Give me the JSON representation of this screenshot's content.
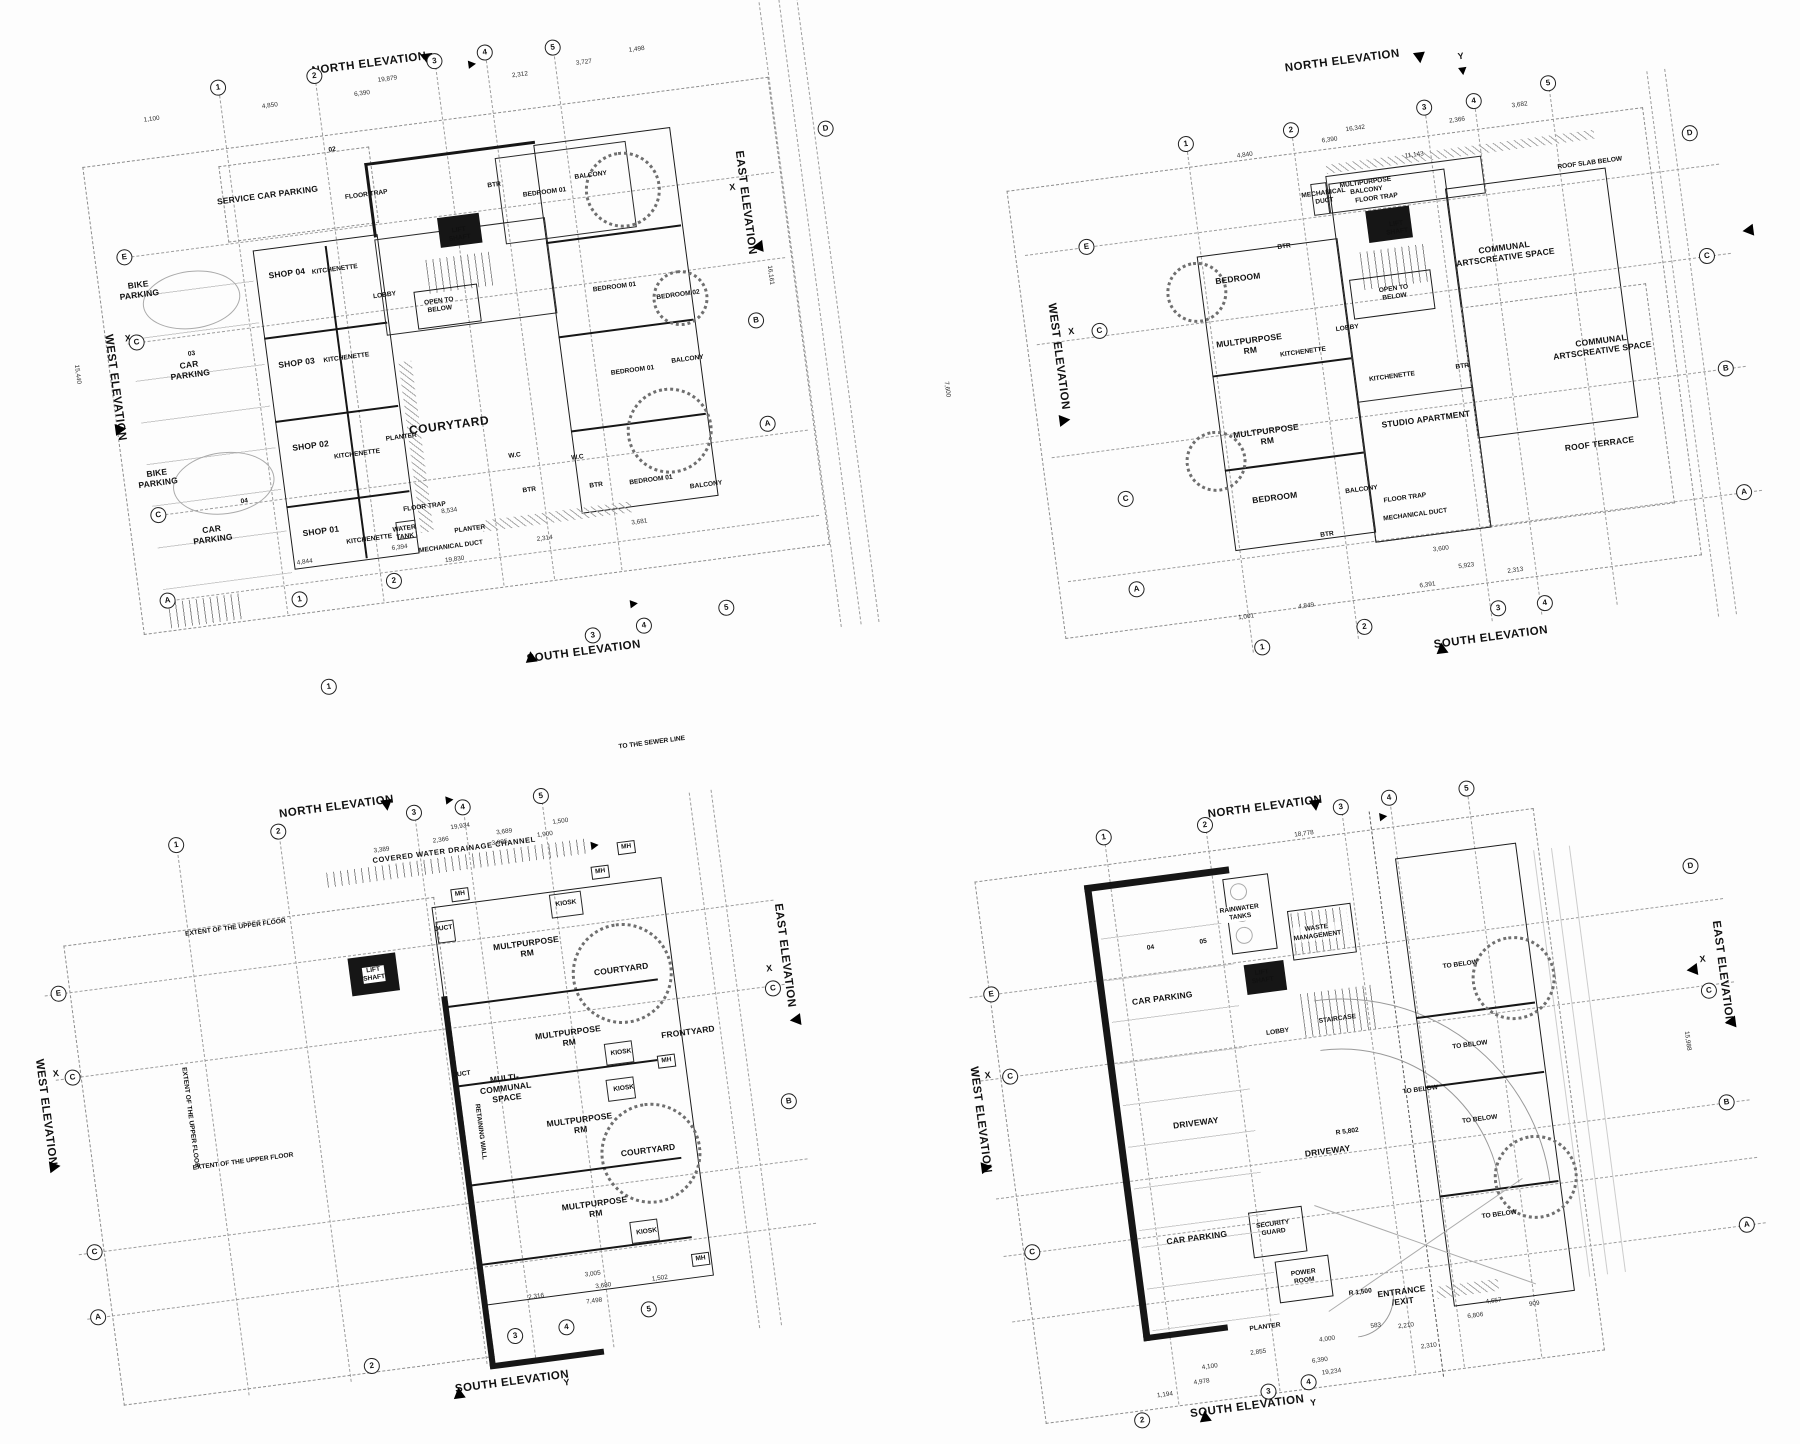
{
  "sheet": {
    "kind": "architectural floor plan drawings",
    "plan_count": 4,
    "ink": "#141414",
    "paper": "#fdfdfd"
  },
  "plans": [
    {
      "elev": {
        "n": "NORTH ELEVATION",
        "s": "SOUTH ELEVATION",
        "w": "WEST ELEVATION",
        "e": "EAST ELEVATION"
      },
      "grid_top": [
        "1",
        "2",
        "3",
        "4",
        "5"
      ],
      "grid_left": [
        "E",
        "C",
        "C",
        "A"
      ],
      "grid_right": [
        "D",
        "B",
        "A"
      ],
      "grid_bottom": [
        "1",
        "2",
        "3",
        "4",
        "5"
      ],
      "marks": [
        "X",
        "X"
      ],
      "rooms": [
        "SERVICE CAR PARKING",
        "FLOOR TRAP",
        "BIKE\nPARKING",
        "SHOP 04",
        "KITCHENETTE",
        "LOBBY",
        "LIFT\nSHAFT",
        "OPEN TO\nBELOW",
        "BTR",
        "BEDROOM 01",
        "BALCONY",
        "BEDROOM 01",
        "BEDROOM 02",
        "BALCONY",
        "CAR\nPARKING",
        "SHOP 03",
        "KITCHENETTE",
        "COURYTARD",
        "PLANTER",
        "W.C",
        "BTR",
        "BEDROOM 01",
        "BALCONY",
        "BIKE\nPARKING",
        "SHOP 02",
        "KITCHENETTE",
        "CAR\nPARKING",
        "SHOP 01",
        "KITCHENETTE",
        "WATER\nTANK",
        "FLOOR TRAP",
        "PLANTER",
        "MECHANICAL DUCT",
        "BEDROOM 01",
        "BTR",
        "W.C",
        "02",
        "03",
        "04"
      ],
      "dims": [
        "19,879",
        "6,390",
        "4,850",
        "1,100",
        "2,312",
        "3,727",
        "1,498",
        "19,830",
        "6,394",
        "4,844",
        "8,534",
        "2,314",
        "3,681",
        "15,440",
        "16,161"
      ]
    },
    {
      "elev": {
        "n": "NORTH ELEVATION",
        "s": "SOUTH ELEVATION",
        "w": "WEST ELEVATION"
      },
      "grid_top": [
        "1",
        "2",
        "3",
        "4",
        "5"
      ],
      "grid_left": [
        "E",
        "C",
        "C",
        "A"
      ],
      "grid_right": [
        "D",
        "C",
        "B",
        "A"
      ],
      "grid_bottom": [
        "1",
        "2",
        "3",
        "4"
      ],
      "marks": [
        "Y",
        "X"
      ],
      "rooms": [
        "MULTIPURPOSE\nBALCONY",
        "MECHANICAL\nDUCT",
        "FLOOR TRAP",
        "LIFT\nSHAFT",
        "ROOF SLAB BELOW",
        "BTR",
        "BEDROOM",
        "OPEN TO\nBELOW",
        "COMMUNAL\nARTSCREATIVE SPACE",
        "MULTPURPOSE\nRM",
        "KITCHENETTE",
        "LOBBY",
        "BTR",
        "KITCHENETTE",
        "STUDIO APARTMENT",
        "COMMUNAL\nARTSCREATIVE SPACE",
        "ROOF TERRACE",
        "MULTPURPOSE\nRM",
        "BEDROOM",
        "BALCONY",
        "FLOOR TRAP",
        "MECHANICAL DUCT",
        "BTR"
      ],
      "dims": [
        "16,342",
        "6,390",
        "4,840",
        "2,366",
        "3,682",
        "11,143",
        "4,849",
        "6,391",
        "1,001",
        "5,923",
        "2,313",
        "3,600",
        "7,600"
      ]
    },
    {
      "elev": {
        "n": "NORTH ELEVATION",
        "s": "SOUTH ELEVATION",
        "w": "WEST ELEVATION",
        "e": "EAST ELEVATION"
      },
      "grid_top": [
        "1",
        "2",
        "3",
        "4",
        "5",
        "1"
      ],
      "grid_left": [
        "E",
        "C",
        "C",
        "A"
      ],
      "grid_right": [
        "C",
        "B"
      ],
      "grid_bottom": [
        "2",
        "3",
        "4",
        "5"
      ],
      "marks": [
        "X",
        "X",
        "Y"
      ],
      "mh": [
        "MH",
        "MH",
        "MH",
        "MH",
        "MH"
      ],
      "rooms": [
        "COVERED WATER DRAINAGE CHANNEL",
        "TO THE SEWER LINE",
        "KIOSK",
        "MULTPURPOSE\nRM",
        "COURTYARD",
        "LIFT\nSHAFT",
        "DUCT",
        "EXTENT OF THE UPPER FLOOR",
        "MULTPURPOSE\nRM",
        "KIOSK",
        "KIOSK",
        "FRONTYARD",
        "MULTI-\nCOMMUNAL\nSPACE",
        "DUCT",
        "RETAINING WALL",
        "MULTPURPOSE\nRM",
        "COURTYARD",
        "MULTPURPOSE\nRM",
        "KIOSK",
        "EXTENT OF THE UPPER FLOOR",
        "EXTENT OF THE UPPER FLOOR"
      ],
      "dims": [
        "19,934",
        "2,366",
        "3,689",
        "1,500",
        "3,389",
        "3,005",
        "1,900",
        "2,316",
        "7,498",
        "3,680",
        "3,005",
        "1,502"
      ]
    },
    {
      "elev": {
        "n": "NORTH ELEVATION",
        "s": "SOUTH ELEVATION",
        "w": "WEST ELEVATION",
        "e": "EAST ELEVATION"
      },
      "grid_top": [
        "1",
        "2",
        "3",
        "4",
        "5"
      ],
      "grid_left": [
        "E",
        "C",
        "C"
      ],
      "grid_right": [
        "D",
        "C",
        "B",
        "A"
      ],
      "grid_bottom": [
        "2",
        "3",
        "4"
      ],
      "marks": [
        "X",
        "X",
        "Y"
      ],
      "rooms": [
        "RAINWATER\nTANKS",
        "WASTE\nMANAGEMENT",
        "TO BELOW",
        "LIFT\nSHAFT",
        "CAR PARKING",
        "STAIRCASE",
        "LOBBY",
        "TO BELOW",
        "TO BELOW",
        "TO BELOW",
        "DRIVEWAY",
        "R 5,802",
        "DRIVEWAY",
        "SECURITY\nGUARD",
        "CAR PARKING",
        "POWER\nROOM",
        "R 1,500",
        "ENTRANCE\n/EXIT",
        "TO BELOW",
        "PLANTER",
        "04",
        "05"
      ],
      "dims": [
        "18,778",
        "15,988",
        "1,194",
        "4,978",
        "4,100",
        "2,855",
        "4,000",
        "583",
        "2,210",
        "6,390",
        "19,234",
        "2,310",
        "6,806",
        "4,657",
        "909"
      ]
    }
  ]
}
